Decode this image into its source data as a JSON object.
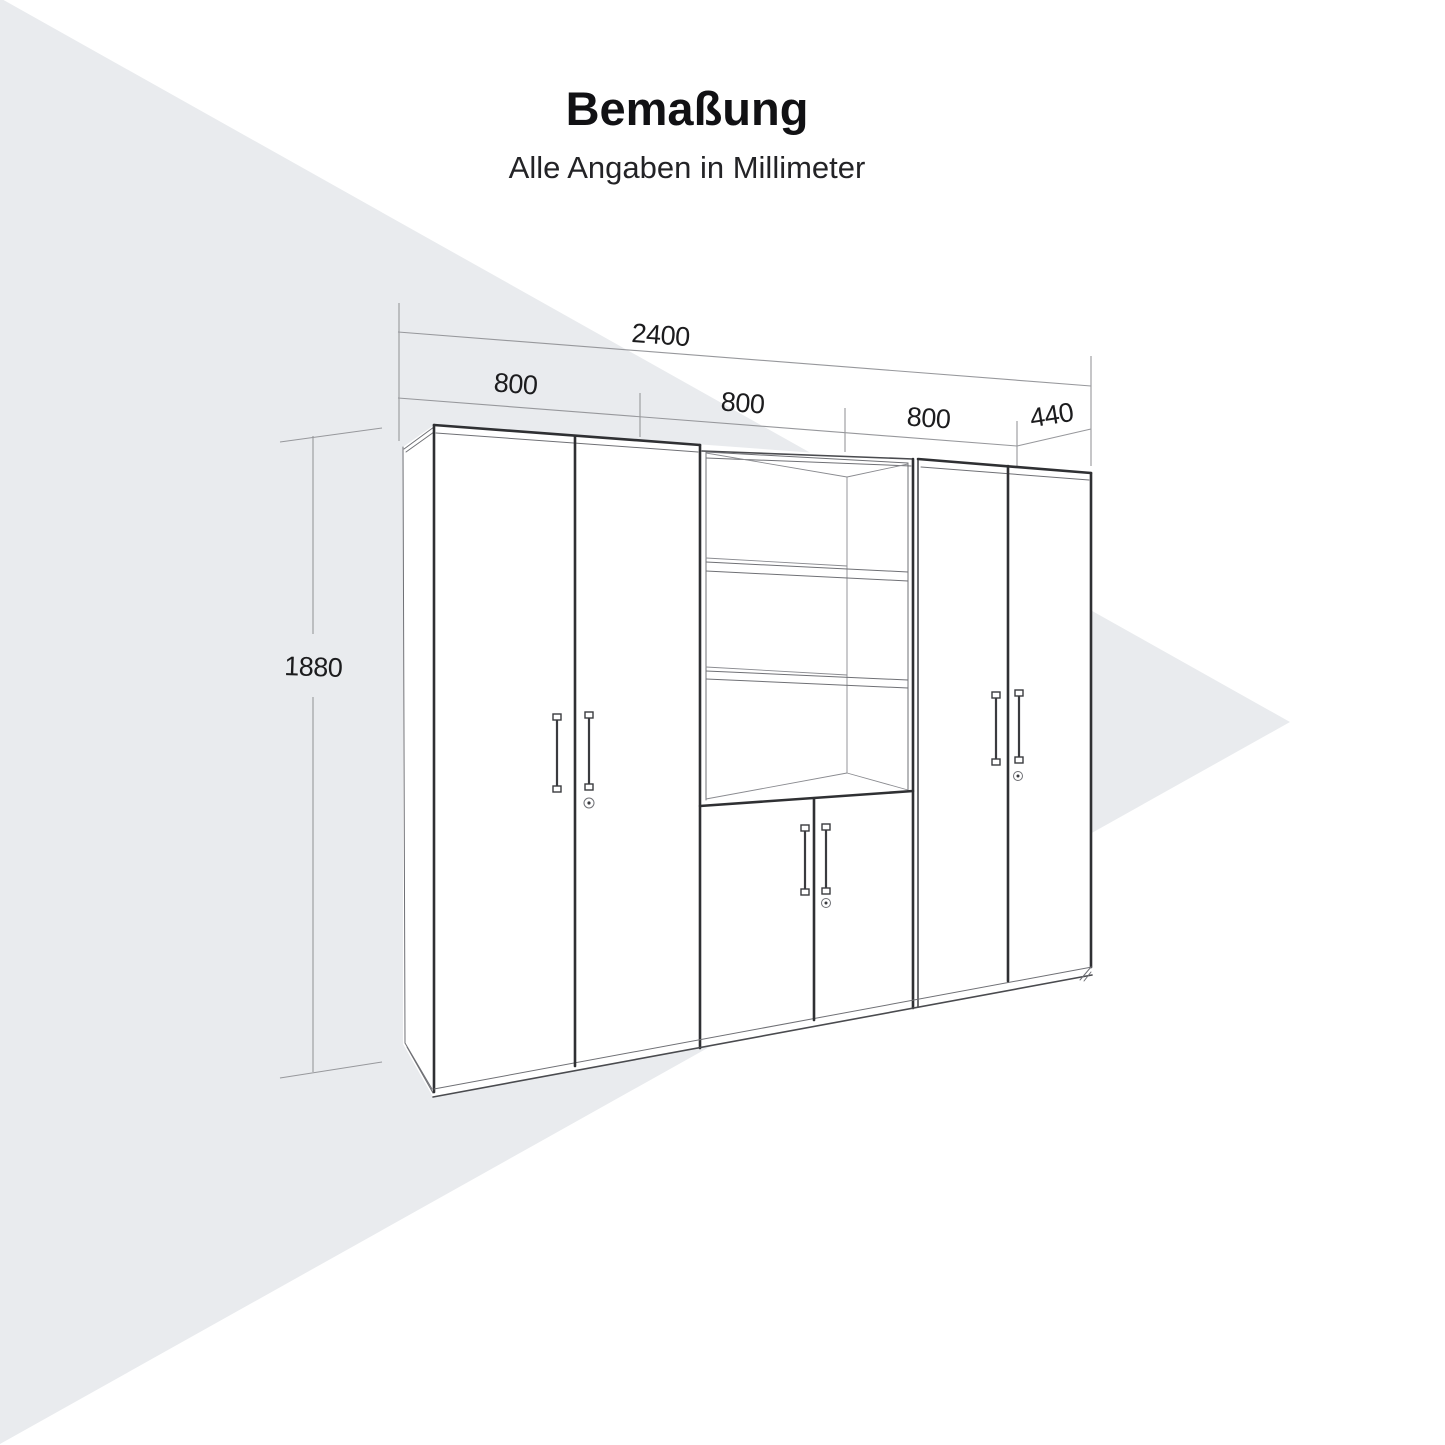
{
  "title": {
    "text": "Bemaßung",
    "subtitle": "Alle Angaben in Millimeter"
  },
  "dimensions": {
    "total_width": "2400",
    "section_widths": [
      "800",
      "800",
      "800"
    ],
    "depth": "440",
    "height": "1880"
  },
  "drawing": {
    "type": "furniture-dimension-diagram",
    "object": "wardrobe-wall-unit-with-open-shelf-section"
  },
  "colors": {
    "background": "#ffffff",
    "wedge": "#e9ebee",
    "line_strong": "#2f3033",
    "line_thin": "#6f7075",
    "dimension_line": "#97989c",
    "text": "#1c1c1e"
  }
}
